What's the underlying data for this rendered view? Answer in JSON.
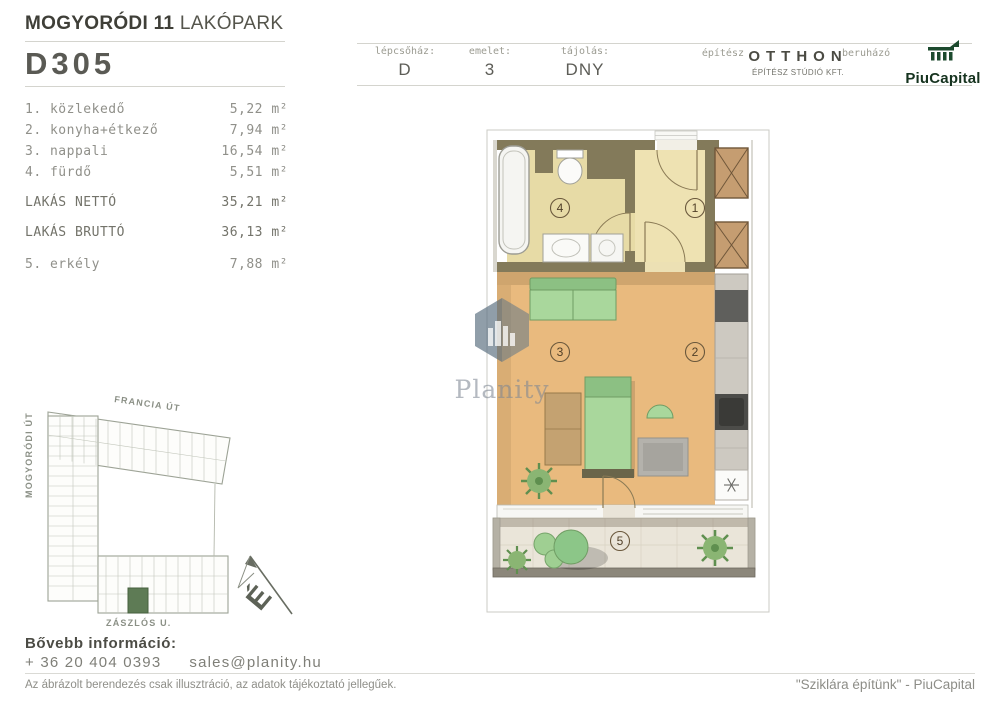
{
  "header": {
    "project_title_bold": "MOGYORÓDI 11",
    "project_title_light": "LAKÓPARK",
    "unit_id": "D305",
    "meta": [
      {
        "label": "lépcsőház:",
        "value": "D"
      },
      {
        "label": "emelet:",
        "value": "3"
      },
      {
        "label": "tájolás:",
        "value": "DNY"
      }
    ],
    "architect_label": "építész",
    "architect_name": "OTTHON",
    "architect_sub": "ÉPÍTÉSZ STÚDIÓ KFT.",
    "developer_label": "beruházó",
    "developer_name": "PiuCapital"
  },
  "rooms": {
    "items": [
      {
        "label": "1. közlekedő",
        "area": "5,22 m²"
      },
      {
        "label": "2. konyha+étkező",
        "area": "7,94 m²"
      },
      {
        "label": "3. nappali",
        "area": "16,54 m²"
      },
      {
        "label": "4. fürdő",
        "area": "5,51 m²"
      }
    ],
    "totals": [
      {
        "label": "LAKÁS NETTÓ",
        "area": "35,21 m²"
      },
      {
        "label": "LAKÁS BRUTTÓ",
        "area": "36,13 m²"
      }
    ],
    "extra": {
      "label": "5. erkély",
      "area": "7,88 m²"
    }
  },
  "floorplan": {
    "rooms": [
      "1",
      "2",
      "3",
      "4",
      "5"
    ]
  },
  "siteplan": {
    "streets": {
      "top": "FRANCIA ÚT",
      "left": "MOGYORÓDI ÚT",
      "bottom": "ZÁSZLÓS U."
    },
    "compass_letter": "É"
  },
  "contact": {
    "heading": "Bővebb információ:",
    "phone": "+ 36 20 404 0393",
    "email": "sales@planity.hu"
  },
  "footer": {
    "disclaimer": "Az ábrázolt berendezés csak illusztráció, az adatok tájékoztató jellegűek.",
    "slogan": "\"Sziklára építünk\" - PiuCapital"
  },
  "watermark": {
    "text": "Planity"
  },
  "colors": {
    "brand_green": "#1c4a2e",
    "wall_olive": "#837a5a",
    "floor_wood": "#e9ba7e",
    "floor_bath": "#e7dba6",
    "furniture_green": "#a9d79c",
    "site_highlight": "#5e7b55"
  }
}
